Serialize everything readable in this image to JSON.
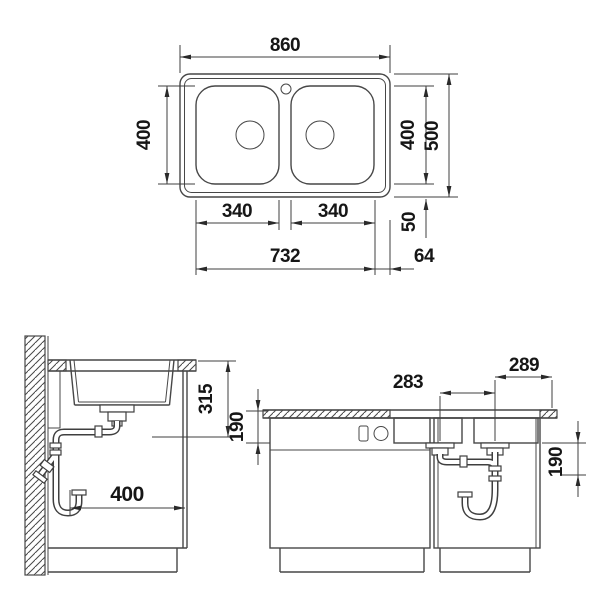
{
  "colors": {
    "line": "#474747",
    "text": "#161616",
    "background": "#ffffff"
  },
  "top_view": {
    "dims": {
      "overall_width": "860",
      "bowl_length": "400",
      "inner_depth": "400",
      "overall_depth": "500",
      "bowl_width_left": "340",
      "bowl_width_right": "340",
      "rear_gap": "50",
      "cutout_width": "732",
      "edge_offset": "64"
    }
  },
  "side_view": {
    "dims": {
      "worktop_clearance": "315",
      "cabinet_depth": "400"
    }
  },
  "front_view": {
    "dims": {
      "drain_spacing": "283",
      "drain_to_edge": "289",
      "bowl_depth": "190",
      "trap_clearance": "190"
    }
  }
}
